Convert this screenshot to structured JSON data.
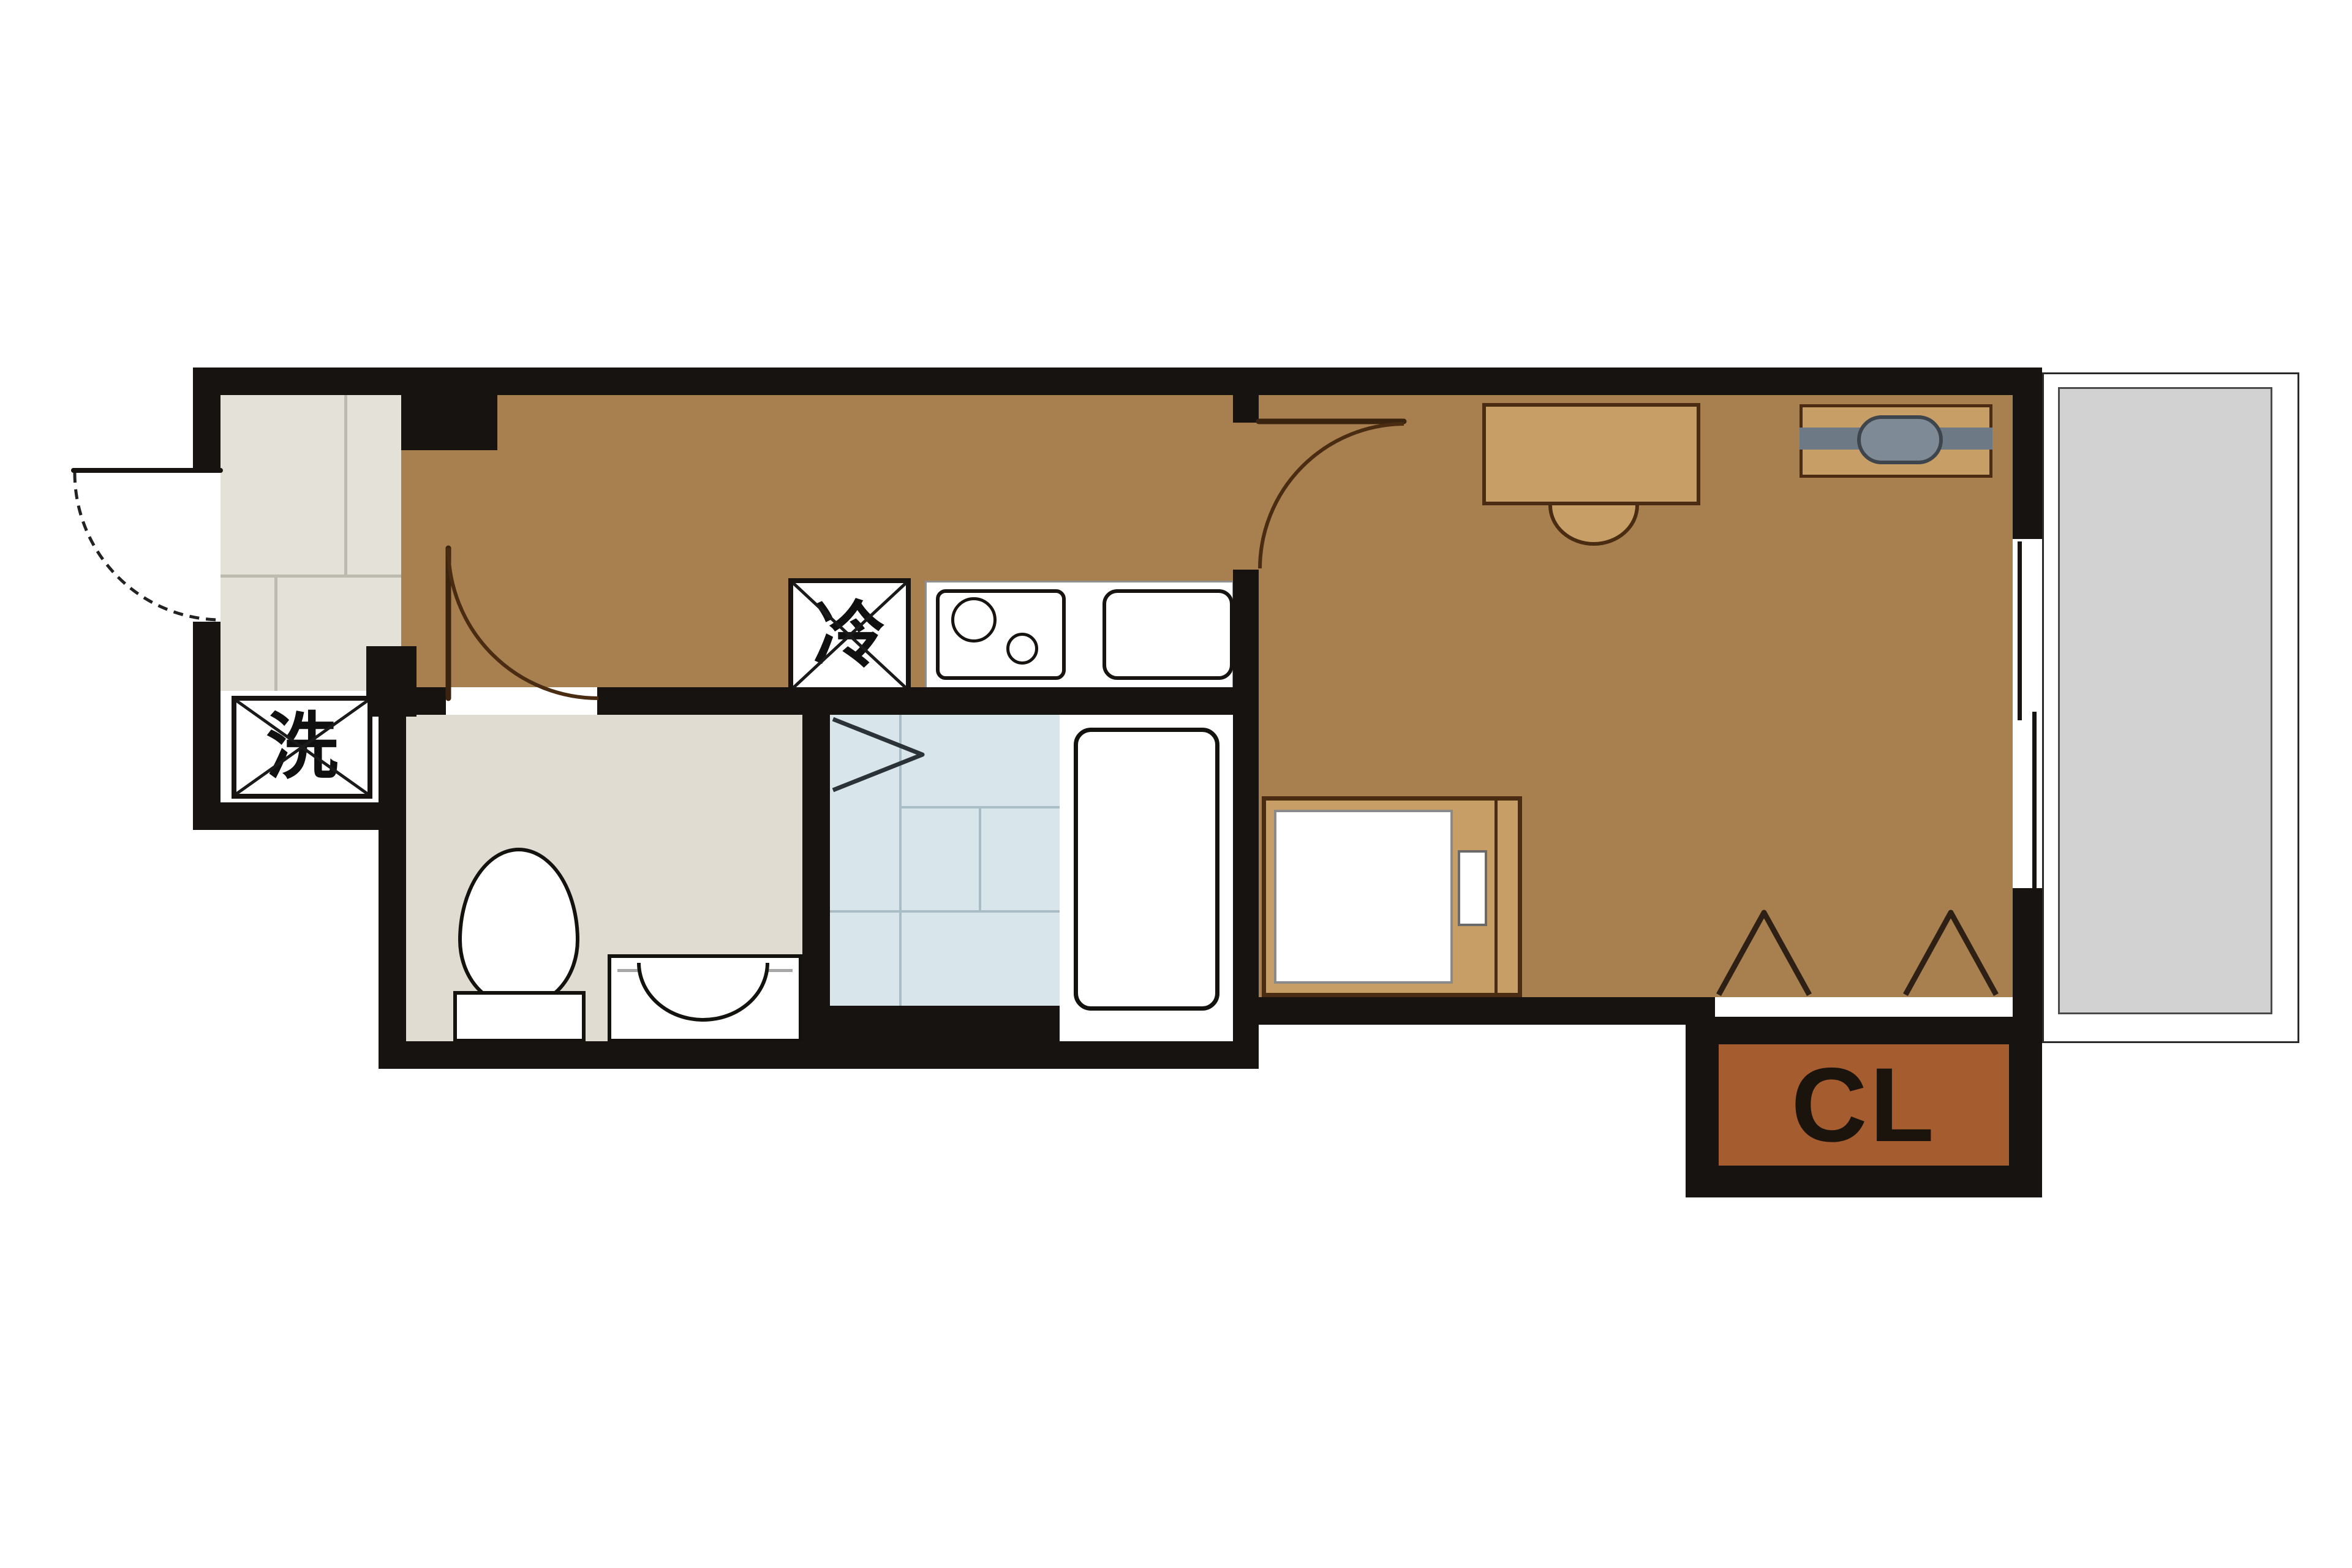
{
  "floorplan": {
    "labels": {
      "refrigerator": "冷",
      "washing_machine": "洗",
      "closet": "CL"
    },
    "colors": {
      "wall": "#171310",
      "wood_floor": "#A8804F",
      "furniture_tan": "#C79E66",
      "furniture_outline": "#4a2c12",
      "entrance_tile": "#E4E1D8",
      "tile_joint": "#bdbab0",
      "washroom_floor": "#E0DCD2",
      "bath_tile": "#D8E5EB",
      "bath_tile_joint": "#a9bdc7",
      "closet_fill": "#A55C2F",
      "balcony_floor": "#D2D2D2",
      "fixture_white": "#FFFFFF",
      "tv_bar_gray": "#6d7a86",
      "tv_capsule_gray": "#7e8b96"
    },
    "icons": [
      "front-door-swing-icon",
      "interior-door-swing-icon",
      "washroom-door-swing-icon",
      "refrigerator-box-icon",
      "washing-machine-box-icon",
      "gas-stove-icon",
      "burner-icon",
      "kitchen-sink-icon",
      "toilet-icon",
      "vanity-basin-icon",
      "bathtub-icon",
      "bath-folding-door-icon",
      "bed-icon",
      "pillow-icon",
      "desk-icon",
      "chair-icon",
      "tv-board-icon",
      "closet-door-chevron-icon",
      "sliding-window-icon",
      "balcony-icon"
    ]
  }
}
